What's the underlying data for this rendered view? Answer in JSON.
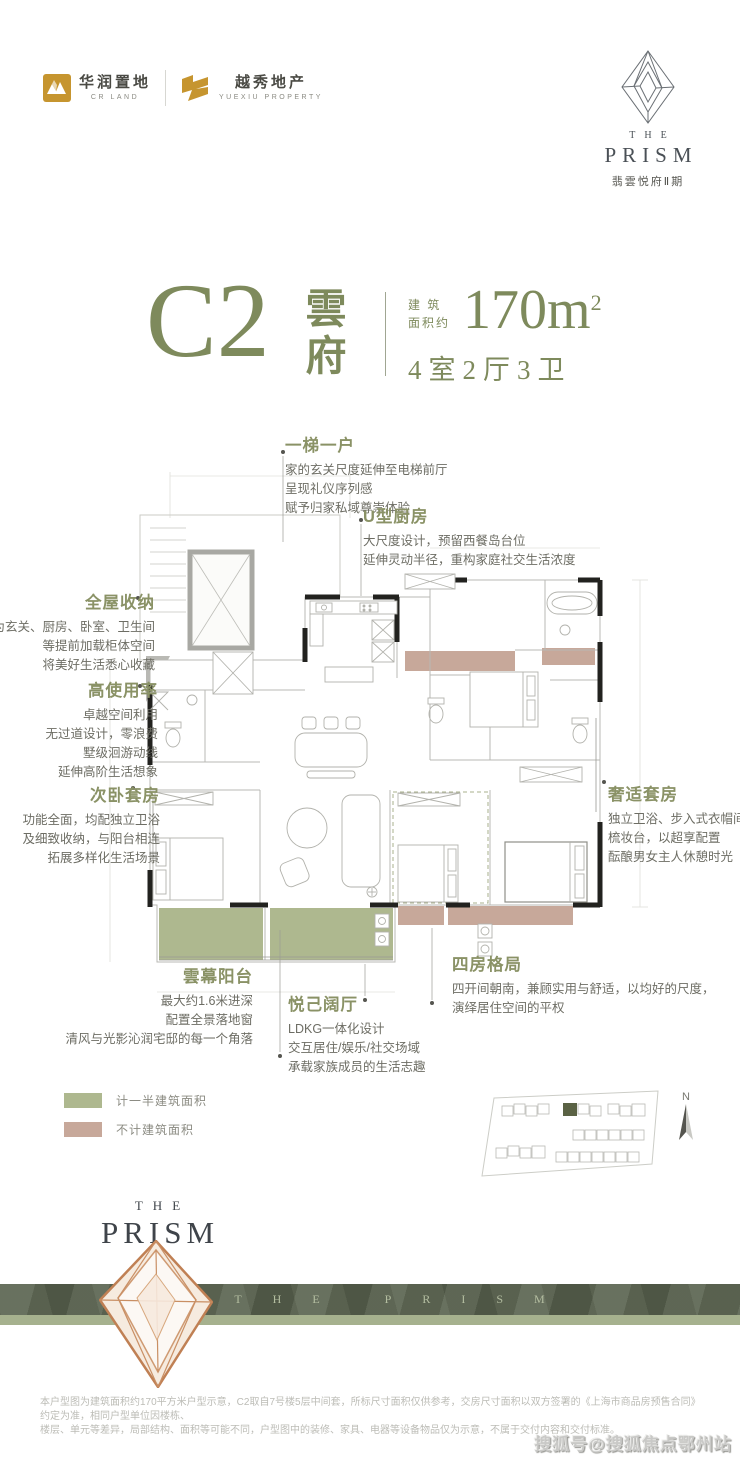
{
  "header": {
    "cr_land": {
      "cn": "华润置地",
      "en": "CR LAND"
    },
    "yuexiu": {
      "cn": "越秀地产",
      "en": "YUEXIU PROPERTY"
    },
    "brand": {
      "the": "THE",
      "prism": "PRISM",
      "sub": "翡雲悦府Ⅱ期"
    }
  },
  "title": {
    "code": "C2",
    "name_char_1": "雲",
    "name_char_2": "府",
    "area_label_line1": "建 筑",
    "area_label_line2": "面积约",
    "area_value": "170m",
    "area_sup": "2",
    "layout": "4室2厅3卫"
  },
  "annotations": [
    {
      "title": "一梯一户",
      "lines": [
        "家的玄关尺度延伸至电梯前厅",
        "呈现礼仪序列感",
        "赋予归家私域尊崇体验"
      ]
    },
    {
      "title": "U型厨房",
      "lines": [
        "大尺度设计，预留西餐岛台位",
        "延伸灵动半径，重构家庭社交生活浓度"
      ]
    },
    {
      "title": "全屋收纳",
      "lines": [
        "为玄关、厨房、卧室、卫生间",
        "等提前加载柜体空间",
        "将美好生活悉心收藏"
      ]
    },
    {
      "title": "高使用率",
      "lines": [
        "卓越空间利用",
        "无过道设计，零浪费",
        "墅级洄游动线",
        "延伸高阶生活想象"
      ]
    },
    {
      "title": "次卧套房",
      "lines": [
        "功能全面，均配独立卫浴",
        "及细致收纳，与阳台相连",
        "拓展多样化生活场景"
      ]
    },
    {
      "title": "奢适套房",
      "lines": [
        "独立卫浴、步入式衣帽间",
        "梳妆台，以超享配置",
        "酝酿男女主人休憩时光"
      ]
    },
    {
      "title": "雲幕阳台",
      "lines": [
        "最大约1.6米进深",
        "配置全景落地窗",
        "清风与光影沁润宅邸的每一个角落"
      ]
    },
    {
      "title": "悦己阔厅",
      "lines": [
        "LDKG一体化设计",
        "交互居住/娱乐/社交场域",
        "承载家族成员的生活志趣"
      ]
    },
    {
      "title": "四房格局",
      "lines": [
        "四开间朝南，兼顾实用与舒适，以均好的尺度，",
        "演绎居住空间的平权"
      ]
    }
  ],
  "legend": [
    {
      "label": "计一半建筑面积",
      "color": "#AEB88F"
    },
    {
      "label": "不计建筑面积",
      "color": "#C7A89A"
    }
  ],
  "siteplan": {
    "compass_label": "N"
  },
  "footer": {
    "brand_the": "THE",
    "brand_prism": "PRISM",
    "banner_text": "THE PRISM"
  },
  "disclaimer": {
    "line1": "本户型图为建筑面积约170平方米户型示意，C2取自7号楼5层中间套，所标尺寸面积仅供参考，交房尺寸面积以双方签署的《上海市商品房预售合同》约定为准，相同户型单位因楼栋、",
    "line2": "楼层、单元等差异，局部结构、面积等可能不同，户型图中的装修、家具、电器等设备物品仅为示意，不属于交付内容和交付标准。"
  },
  "watermark": "搜狐号@搜狐焦点鄂州站",
  "colors": {
    "accent_sage": "#7E8A5C",
    "annotation_head": "#8A9266",
    "legend_green": "#AEB88F",
    "legend_pink": "#C7A89A",
    "banner_dark": "#59624E",
    "banner_light": "#A6B18E",
    "logo_gold": "#C6952F",
    "plan_wall": "#222220",
    "crystal_gold": "#C08054"
  }
}
